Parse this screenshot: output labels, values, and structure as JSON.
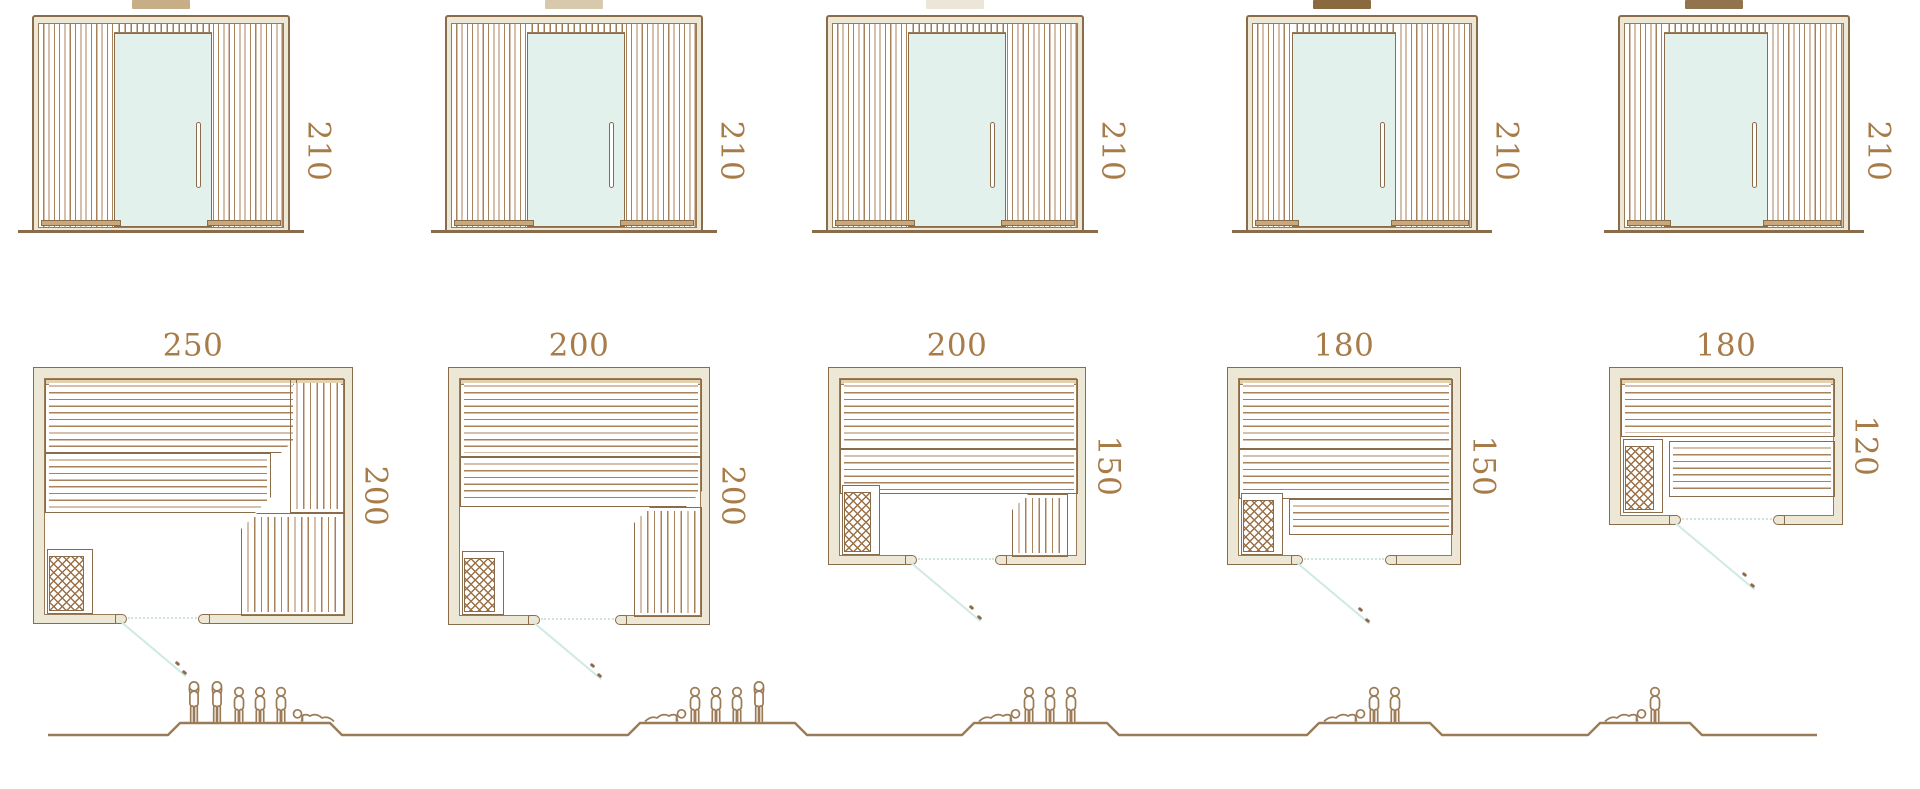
{
  "colors": {
    "line": "#8a6b4a",
    "line2": "#9b7b55",
    "slat": "#a8825a",
    "hatch": "#9b7147",
    "dim_text": "#a87c48",
    "wall_fill": "#ede7d5",
    "wood": "#c9a87c",
    "glass": "#e3f1ec",
    "swing": "#cfe9e3",
    "swing_dot": "#cfe4de",
    "trim": "#e2d2b0",
    "people": "#9b7b55"
  },
  "saunas": [
    {
      "elevation": {
        "height_cm": "210",
        "front_swatch": "#c8ae87"
      },
      "plan": {
        "width_cm": "250",
        "depth_cm": "200"
      },
      "capacity": {
        "persons": 6,
        "icons": [
          "standing",
          "standing",
          "seated",
          "seated",
          "seated",
          "lying"
        ]
      }
    },
    {
      "elevation": {
        "height_cm": "210",
        "front_swatch": "#d8c9ad"
      },
      "plan": {
        "width_cm": "200",
        "depth_cm": "200"
      },
      "capacity": {
        "persons": 5,
        "icons": [
          "lying",
          "seated",
          "seated",
          "seated",
          "standing"
        ]
      }
    },
    {
      "elevation": {
        "height_cm": "210",
        "front_swatch": "#ece6d9"
      },
      "plan": {
        "width_cm": "200",
        "depth_cm": "150"
      },
      "capacity": {
        "persons": 4,
        "icons": [
          "lying",
          "seated",
          "seated",
          "seated"
        ]
      }
    },
    {
      "elevation": {
        "height_cm": "210",
        "front_swatch": "#8a693f"
      },
      "plan": {
        "width_cm": "180",
        "depth_cm": "150"
      },
      "capacity": {
        "persons": 3,
        "icons": [
          "lying",
          "seated",
          "seated"
        ]
      }
    },
    {
      "elevation": {
        "height_cm": "210",
        "front_swatch": "#91744e"
      },
      "plan": {
        "width_cm": "180",
        "depth_cm": "120"
      },
      "capacity": {
        "persons": 2,
        "icons": [
          "lying",
          "seated"
        ]
      }
    }
  ]
}
